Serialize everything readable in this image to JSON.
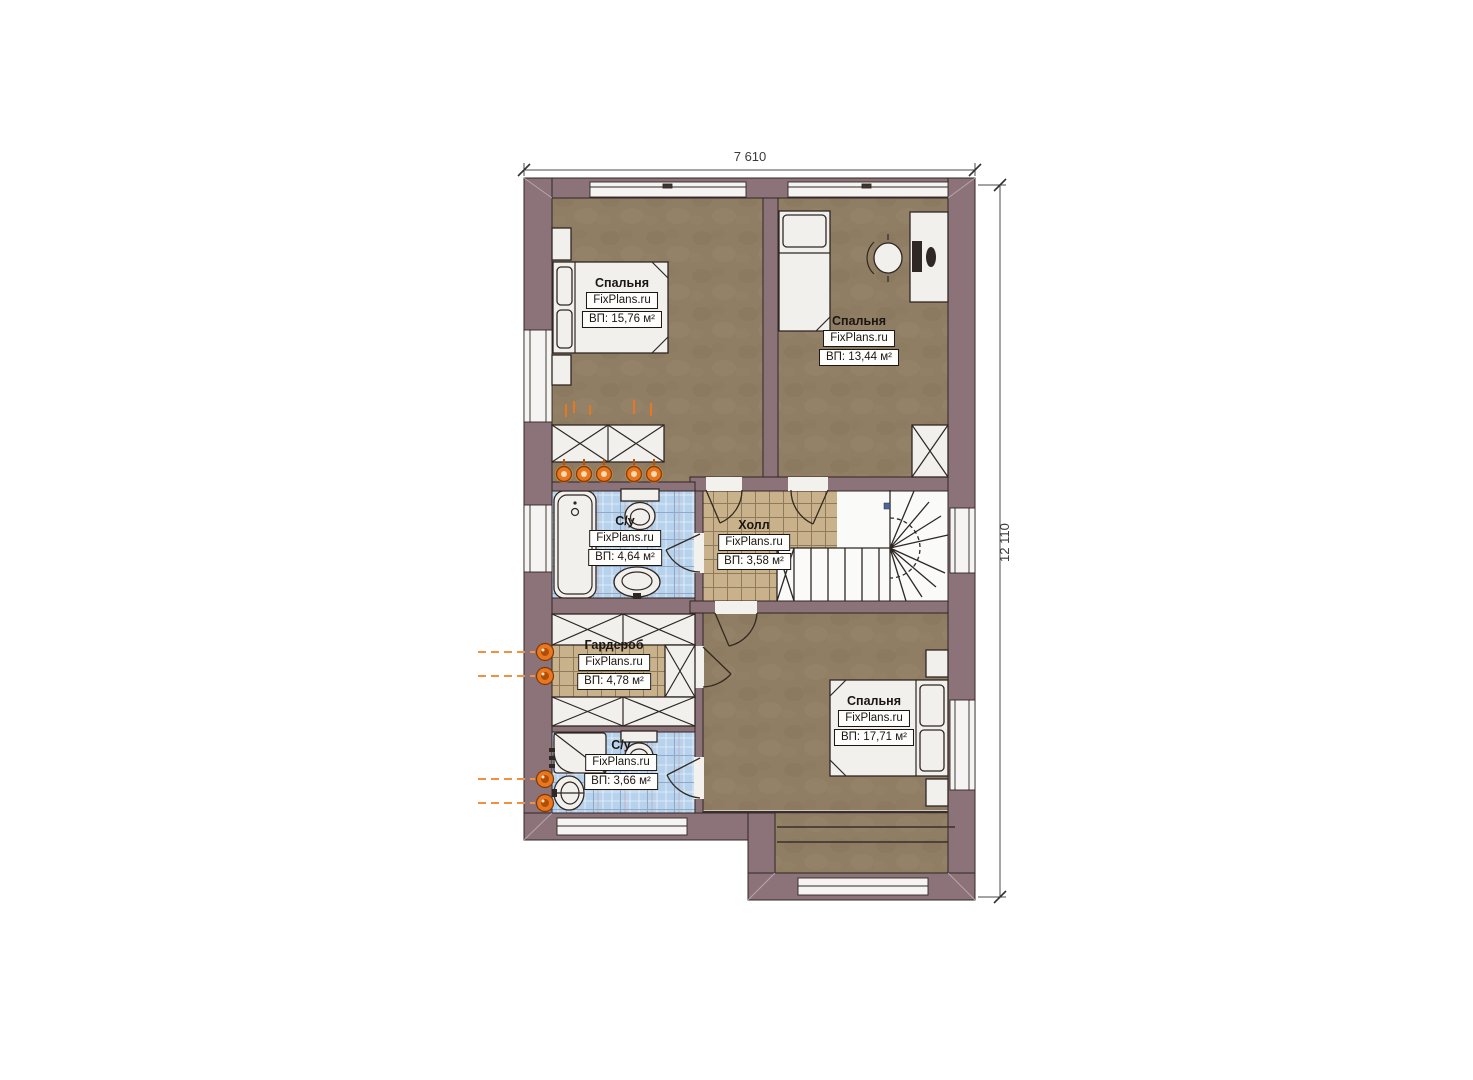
{
  "plan": {
    "type": "apartment-floor-plan",
    "language": "ru"
  },
  "dimensions": {
    "width_label": "7 610",
    "height_label": "12 110"
  },
  "branding": {
    "watermark": "FixPlans.ru"
  },
  "rooms": [
    {
      "id": "bedroom-top-left",
      "name": "Спальня",
      "watermark": "FixPlans.ru",
      "area_label": "ВП: 15,76 м²"
    },
    {
      "id": "bedroom-top-right",
      "name": "Спальня",
      "watermark": "FixPlans.ru",
      "area_label": "ВП: 13,44 м²"
    },
    {
      "id": "bathroom-upper",
      "name": "С/у",
      "watermark": "FixPlans.ru",
      "area_label": "ВП: 4,64 м²"
    },
    {
      "id": "hall",
      "name": "Холл",
      "watermark": "FixPlans.ru",
      "area_label": "ВП: 3,58 м²"
    },
    {
      "id": "wardrobe",
      "name": "Гардероб",
      "watermark": "FixPlans.ru",
      "area_label": "ВП: 4,78 м²"
    },
    {
      "id": "bathroom-lower",
      "name": "С/у",
      "watermark": "FixPlans.ru",
      "area_label": "ВП: 3,66 м²"
    },
    {
      "id": "bedroom-bottom",
      "name": "Спальня",
      "watermark": "FixPlans.ru",
      "area_label": "ВП: 17,71 м²"
    }
  ],
  "colors": {
    "wall": "#8c7279",
    "wood_floor": "#8f7d64",
    "tile_blue": "#b7d2ec",
    "tile_beige": "#c9b28b",
    "accent_orange": "#e8771f",
    "outline": "#2f2723"
  }
}
